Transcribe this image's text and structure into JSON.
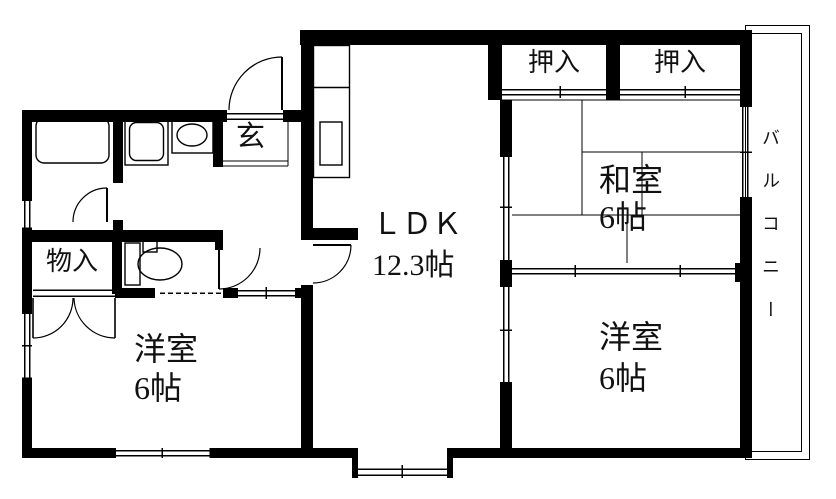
{
  "title": "apartment-floor-plan",
  "colors": {
    "background": "#ffffff",
    "wall": "#000000",
    "line": "#000000",
    "text": "#111111"
  },
  "rooms": {
    "ldk": {
      "name": "ＬＤＫ",
      "size": "12.3帖"
    },
    "washitsu": {
      "name": "和室",
      "size": "6帖"
    },
    "bedroom_right": {
      "name": "洋室",
      "size": "6帖"
    },
    "bedroom_left": {
      "name": "洋室",
      "size": "6帖"
    },
    "closet_top_left": {
      "name": "押入"
    },
    "closet_top_right": {
      "name": "押入"
    },
    "storage": {
      "name": "物入"
    },
    "entrance": {
      "name": "玄"
    },
    "balcony": {
      "name": "バルコニー"
    }
  }
}
